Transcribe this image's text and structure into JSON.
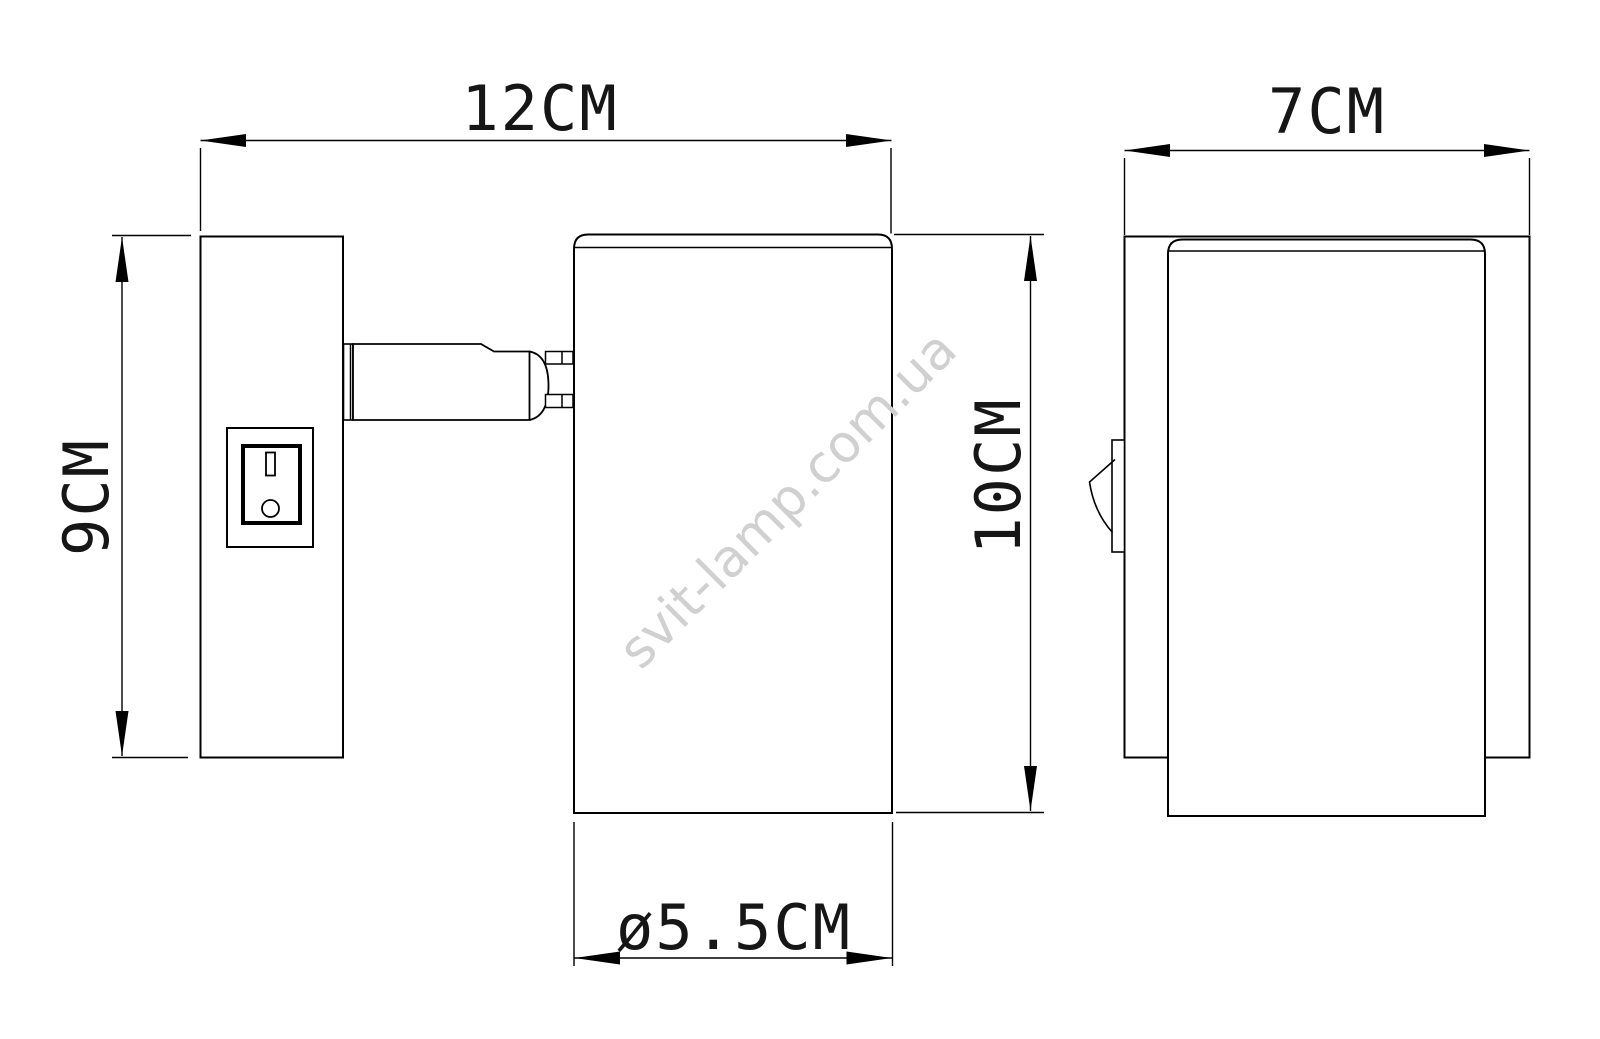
{
  "drawing": {
    "watermark": "svit-lamp.com.ua",
    "colors": {
      "line": "#000000",
      "background": "#ffffff",
      "watermark": "#d0d0d0",
      "label_text": "#161616"
    },
    "dimensions": {
      "overall_width": "12CM",
      "depth": "7CM",
      "backplate_height": "9CM",
      "head_height": "10CM",
      "head_diameter": "ø5.5CM"
    }
  }
}
